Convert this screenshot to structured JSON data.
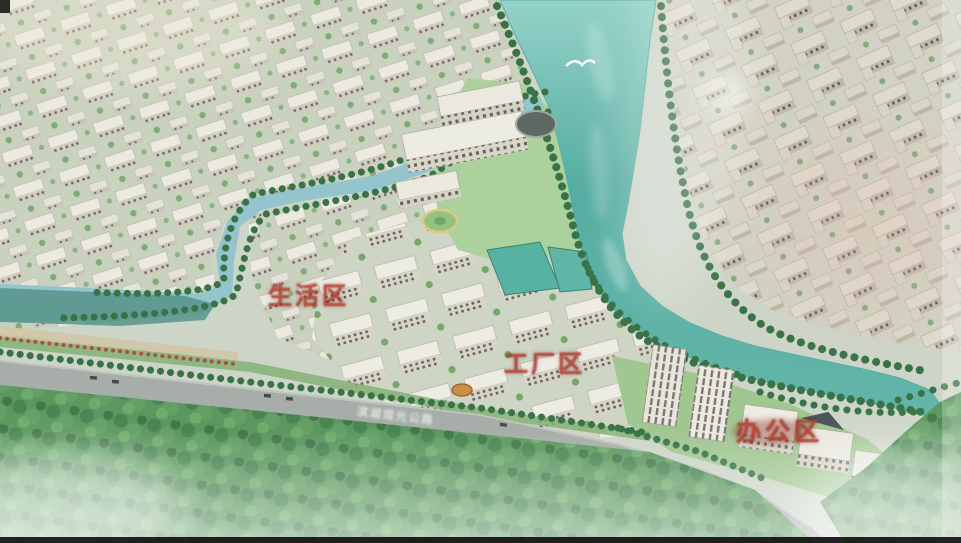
{
  "labels": {
    "living_area": "生活区",
    "factory_area": "工厂区",
    "office_area": "办公区",
    "road_name": "滨湖观光公路"
  },
  "colors": {
    "label_red": "#b23a2c",
    "river_teal": "#54aba0",
    "canal_blue": "#8fc2cb",
    "forest_green": "#539257",
    "road_gray": "#a3aaa6",
    "building_light": "#e9e7de",
    "tree_dark_green": "#2f6b3e"
  }
}
